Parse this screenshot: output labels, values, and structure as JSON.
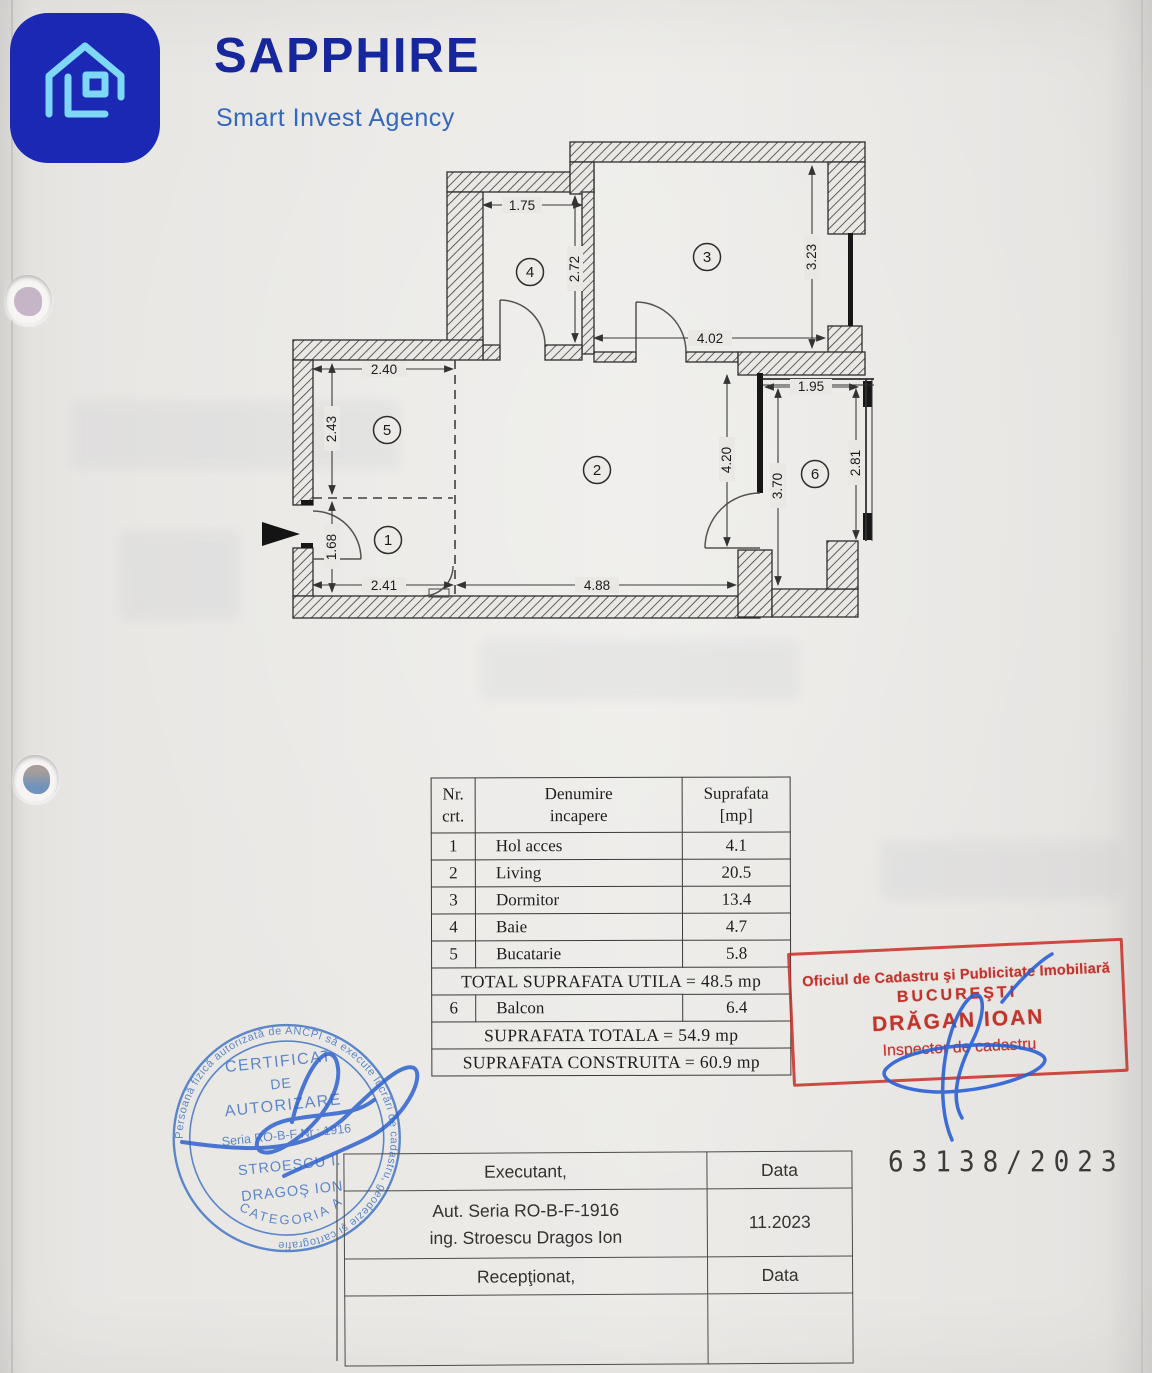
{
  "logo": {
    "brand": "SAPPHIRE",
    "tagline": "Smart Invest Agency",
    "square_color": "#1a28b4",
    "icon_color": "#7ed7f7",
    "brand_color": "#16279e",
    "tagline_color": "#3468bd"
  },
  "plan": {
    "rooms": {
      "r1": "1",
      "r2": "2",
      "r3": "3",
      "r4": "4",
      "r5": "5",
      "r6": "6"
    },
    "dims": {
      "baie_width": "1.75",
      "baie_height": "2.72",
      "dormitor_width": "4.02",
      "dormitor_height": "3.23",
      "bucatarie_width": "2.40",
      "bucatarie_height": "2.43",
      "hol_height": "1.68",
      "hol_width": "2.41",
      "living_width": "4.88",
      "living_height": "4.20",
      "balcon_width": "1.95",
      "balcon_left_height": "3.70",
      "balcon_right_height": "2.81"
    }
  },
  "area_table": {
    "header": {
      "nr_l1": "Nr.",
      "nr_l2": "crt.",
      "name_l1": "Denumire",
      "name_l2": "incapere",
      "area_l1": "Suprafata",
      "area_l2": "[mp]"
    },
    "rows": [
      {
        "nr": "1",
        "name": "Hol acces",
        "area": "4.1"
      },
      {
        "nr": "2",
        "name": "Living",
        "area": "20.5"
      },
      {
        "nr": "3",
        "name": "Dormitor",
        "area": "13.4"
      },
      {
        "nr": "4",
        "name": "Baie",
        "area": "4.7"
      },
      {
        "nr": "5",
        "name": "Bucatarie",
        "area": "5.8"
      }
    ],
    "total_utila": "TOTAL SUPRAFATA UTILA = 48.5 mp",
    "balcon_row": {
      "nr": "6",
      "name": "Balcon",
      "area": "6.4"
    },
    "total": "SUPRAFATA TOTALA = 54.9 mp",
    "construita": "SUPRAFATA CONSTRUITA = 60.9 mp"
  },
  "red_stamp": {
    "line1": "Oficiul de Cadastru şi Publicitate Imobiliară",
    "line2": "BUCUREŞTI",
    "line3": "DRĂGAN IOAN",
    "line4": "Inspector de cadastru",
    "color": "#c2342b"
  },
  "round_stamp": {
    "ring_text": "Persoană fizică autorizată de ANCPI să execute lucrări de cadastru, geodezie şi cartografie",
    "category": "CATEGORIA A",
    "line1": "CERTIFICAT",
    "line2": "DE",
    "line3": "AUTORIZARE",
    "line4": "Seria RO-B-F Nr.: 1916",
    "line5": "STROESCU I.",
    "line6": "DRAGOŞ ION",
    "color": "#4d7cc8"
  },
  "signature_table": {
    "executant_label": "Executant,",
    "data_label_1": "Data",
    "auth_line1": "Aut. Seria RO-B-F-1916",
    "auth_line2": "ing. Stroescu Dragos Ion",
    "date_value": "11.2023",
    "receptionat_label": "Recepţionat,",
    "data_label_2": "Data"
  },
  "case_number": "63138/2023"
}
